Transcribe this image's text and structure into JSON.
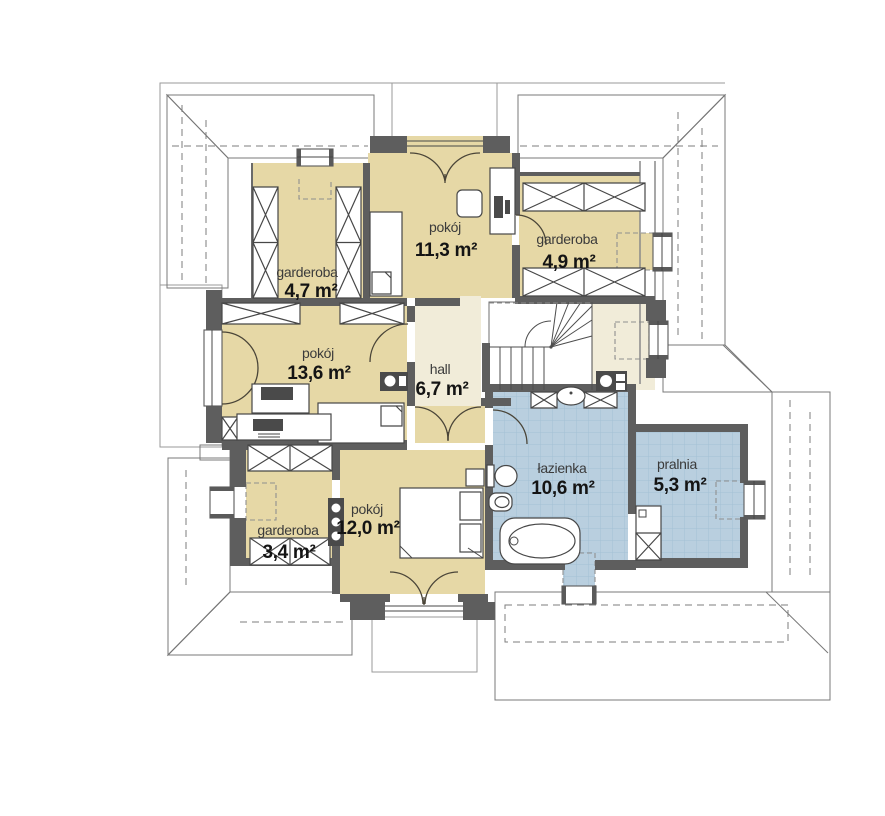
{
  "plan_type": "floor-plan",
  "language": "pl",
  "rooms": [
    {
      "id": "garderoba-nw",
      "name": "garderoba",
      "area": "4,7 m²"
    },
    {
      "id": "pokoj-n",
      "name": "pokój",
      "area": "11,3 m²"
    },
    {
      "id": "garderoba-ne",
      "name": "garderoba",
      "area": "4,9 m²"
    },
    {
      "id": "pokoj-w",
      "name": "pokój",
      "area": "13,6 m²"
    },
    {
      "id": "hall",
      "name": "hall",
      "area": "6,7 m²"
    },
    {
      "id": "garderoba-sw",
      "name": "garderoba",
      "area": "3,4 m²"
    },
    {
      "id": "pokoj-s",
      "name": "pokój",
      "area": "12,0 m²"
    },
    {
      "id": "lazienka",
      "name": "łazienka",
      "area": "10,6 m²"
    },
    {
      "id": "pralnia",
      "name": "pralnia",
      "area": "5,3 m²"
    }
  ],
  "colors": {
    "room_floor": "#e6d8a6",
    "hall_floor": "#f1ecd9",
    "tile_floor": "#b9cfdf",
    "tile_grid": "#a4c0d4",
    "wall": "#5e5e5e",
    "roof_dark": "#9d9d9d",
    "roof_dark_line": "#7b7b7b",
    "roof_light": "#d8d8d8",
    "roof_light_line": "#ababab",
    "roof_med": "#c9cdcd",
    "roof_med_line": "#9ba1a1"
  },
  "icons": [
    "wardrobe-icon",
    "bed-icon",
    "double-bed-icon",
    "desk-icon",
    "computer-icon",
    "printer-icon",
    "chair-icon",
    "bathtub-icon",
    "toilet-icon",
    "bidet-icon",
    "washbasin-icon",
    "washing-machine-icon",
    "radiator-icon",
    "stairs-icon",
    "door-arc-icon",
    "window-icon"
  ]
}
